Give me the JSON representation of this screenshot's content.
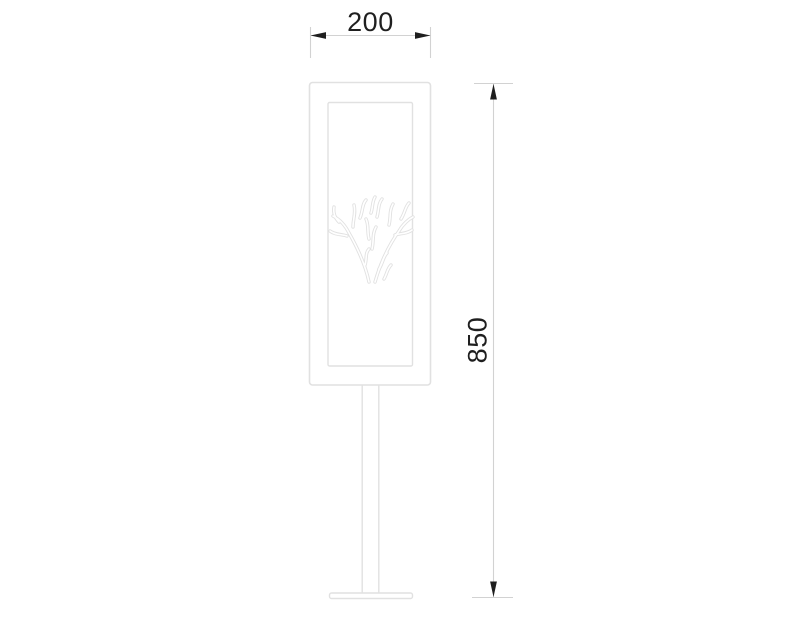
{
  "drawing": {
    "dimensions": {
      "width_label": "200",
      "height_label": "850"
    },
    "colors": {
      "background": "#ffffff",
      "object_line": "#e1e1e1",
      "dimension_line": "#d2d2d2",
      "dimension_text": "#1f1f1f"
    }
  }
}
